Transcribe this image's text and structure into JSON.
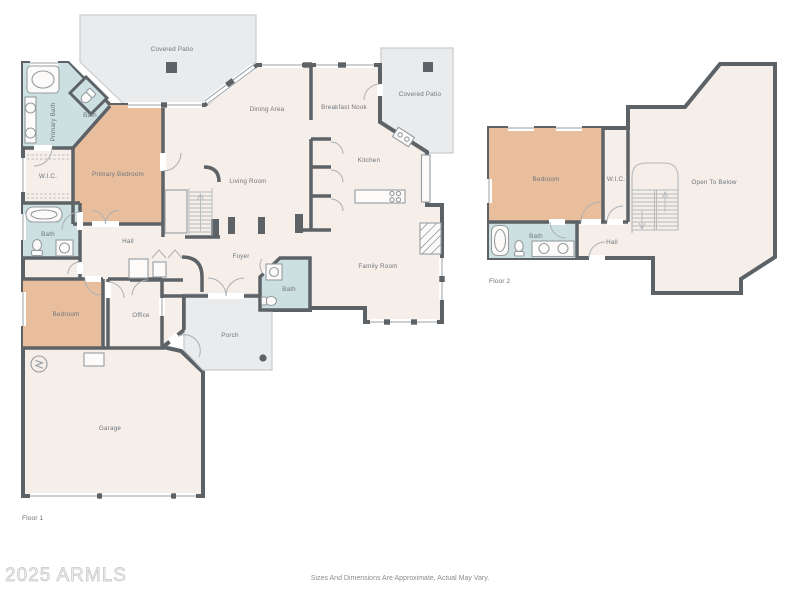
{
  "floor1": {
    "label": "Floor 1",
    "rooms": {
      "covered_patio": "Covered Patio",
      "covered_patio_2": "Covered Patio",
      "primary_bath": "Primary Bath",
      "primary_water_closet": "Bath",
      "primary_bedroom": "Primary Bedroom",
      "wic": "W.I.C.",
      "hall_bath": "Bath",
      "hall": "Hall",
      "bedroom": "Bedroom",
      "office": "Office",
      "dining_area": "Dining Area",
      "living_room": "Living Room",
      "breakfast_nook": "Breakfast Nook",
      "kitchen": "Kitchen",
      "foyer": "Foyer",
      "powder_bath": "Bath",
      "family_room": "Family Room",
      "porch": "Porch",
      "garage": "Garage"
    }
  },
  "floor2": {
    "label": "Floor 2",
    "rooms": {
      "bedroom": "Bedroom",
      "wic": "W.I.C.",
      "open_to_below": "Open To Below",
      "bath": "Bath",
      "hall": "Hall"
    }
  },
  "footer": {
    "watermark": "2025 ARMLS",
    "disclaimer": "Sizes And Dimensions Are Approximate, Actual May Vary."
  },
  "colors": {
    "wall": "#5d6266",
    "floor": "#f6eee8",
    "bedroom_fill": "#e9be9d",
    "bath_fill": "#cde0e1",
    "patio_fill": "#e9ebec",
    "label_text": "#6e767d",
    "watermark_text": "#f0f0f0",
    "disclaimer_text": "#8c8c8c"
  }
}
